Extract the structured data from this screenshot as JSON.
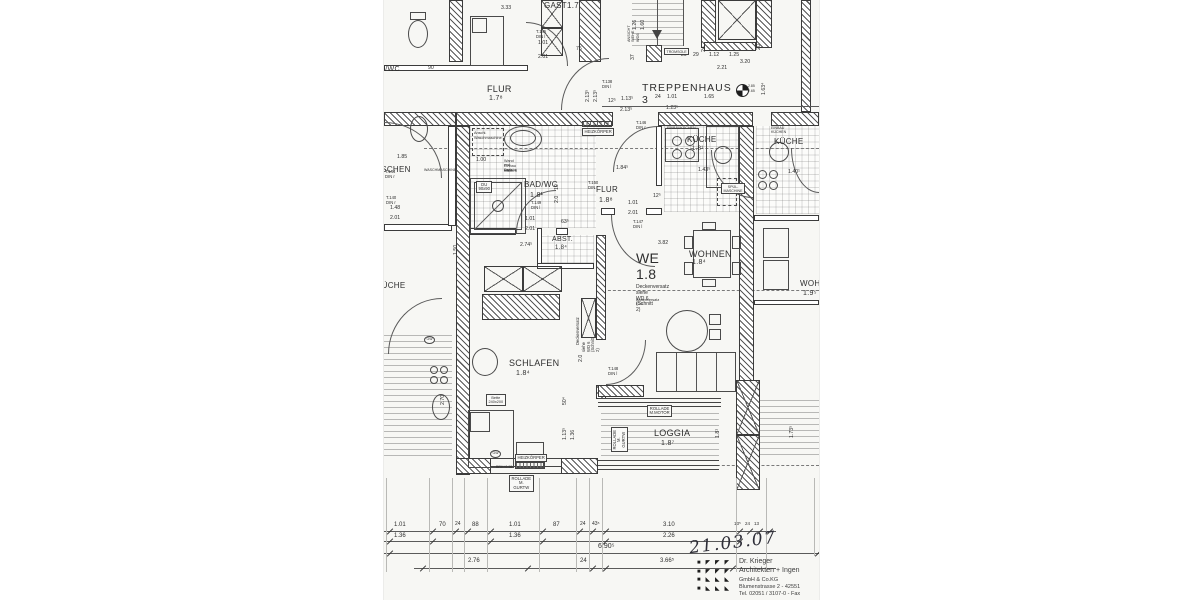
{
  "plan": {
    "room_labels": [
      {
        "t": "GAST1.7",
        "x": 160,
        "y": 2,
        "fs": 8
      },
      {
        "t": "FLUR",
        "x": 103,
        "y": 84,
        "fs": 9
      },
      {
        "t": "1.7⁸",
        "x": 105,
        "y": 95,
        "fs": 7
      },
      {
        "t": "TREPPENHAUS 3",
        "x": 258,
        "y": 83,
        "fs": 10.5,
        "sp": 1
      },
      {
        "t": "BAD/WC",
        "x": 140,
        "y": 181,
        "fs": 8
      },
      {
        "t": "1.8¹",
        "x": 146,
        "y": 192,
        "fs": 7
      },
      {
        "t": "FLUR",
        "x": 212,
        "y": 186,
        "fs": 8
      },
      {
        "t": "1.8⁸",
        "x": 215,
        "y": 197,
        "fs": 7
      },
      {
        "t": "KÜCHE",
        "x": 303,
        "y": 136,
        "fs": 8
      },
      {
        "t": "1.8¹",
        "x": 308,
        "y": 146,
        "fs": 6
      },
      {
        "t": "ABST.",
        "x": 168,
        "y": 236,
        "fs": 7
      },
      {
        "t": "1.8⁴",
        "x": 171,
        "y": 245,
        "fs": 6
      },
      {
        "t": "WE 1.8",
        "x": 252,
        "y": 251,
        "fs": 14
      },
      {
        "t": "WOHNEN",
        "x": 305,
        "y": 249,
        "fs": 9
      },
      {
        "t": "1.8⁴",
        "x": 308,
        "y": 259,
        "fs": 7
      },
      {
        "t": "SCHLAFEN",
        "x": 125,
        "y": 358,
        "fs": 9
      },
      {
        "t": "1.8⁴",
        "x": 132,
        "y": 370,
        "fs": 7
      },
      {
        "t": "LOGGIA",
        "x": 270,
        "y": 428,
        "fs": 9
      },
      {
        "t": "1.8⁷",
        "x": 277,
        "y": 440,
        "fs": 7
      },
      {
        "t": "BAD/WC",
        "x": -14,
        "y": 66,
        "fs": 7
      },
      {
        "t": "WASCHEN",
        "x": -16,
        "y": 166,
        "fs": 8
      },
      {
        "t": "KÜCHE",
        "x": -8,
        "y": 282,
        "fs": 8
      },
      {
        "t": "KÜCHE",
        "x": 390,
        "y": 138,
        "fs": 8
      },
      {
        "t": "WOHNEN",
        "x": 416,
        "y": 280,
        "fs": 8
      },
      {
        "t": "1.9⁵",
        "x": 419,
        "y": 290,
        "fs": 7
      }
    ],
    "door_tags": [
      {
        "t": "T.145\nDIN l",
        "x": 152,
        "y": 30
      },
      {
        "t": "T.138\nDIN l",
        "x": 218,
        "y": 80
      },
      {
        "t": "T.146\nDIN r",
        "x": 252,
        "y": 121
      },
      {
        "t": "T.144\nDIN r",
        "x": 1,
        "y": 170
      },
      {
        "t": "T.140\nDIN r",
        "x": 2,
        "y": 196
      },
      {
        "t": "T.150\nDIN r",
        "x": 204,
        "y": 181
      },
      {
        "t": "T.149\nDIN l",
        "x": 147,
        "y": 201
      },
      {
        "t": "T.147\nDIN l",
        "x": 249,
        "y": 220
      },
      {
        "t": "T.148\nDIN l",
        "x": 224,
        "y": 367
      }
    ],
    "dim_labels": [
      {
        "t": "3.33",
        "x": 117,
        "y": 6
      },
      {
        "t": "1.01",
        "x": 154,
        "y": 41
      },
      {
        "t": "2.01",
        "x": 154,
        "y": 55
      },
      {
        "t": "75",
        "x": 192,
        "y": 47
      },
      {
        "t": "90",
        "x": 44,
        "y": 66
      },
      {
        "t": "1.26",
        "x": 249,
        "y": 30,
        "rot": -90
      },
      {
        "t": "1.60",
        "x": 257,
        "y": 30,
        "rot": -90
      },
      {
        "t": "37",
        "x": 247,
        "y": 60,
        "rot": -90
      },
      {
        "t": "2.13⁵",
        "x": 202,
        "y": 102,
        "rot": -90
      },
      {
        "t": "2.13⁵",
        "x": 210,
        "y": 102,
        "rot": -90
      },
      {
        "t": "12⁵",
        "x": 224,
        "y": 99
      },
      {
        "t": "1.13⁵",
        "x": 237,
        "y": 97
      },
      {
        "t": "2.13⁵",
        "x": 236,
        "y": 108
      },
      {
        "t": "24",
        "x": 271,
        "y": 95
      },
      {
        "t": "1.01",
        "x": 283,
        "y": 95
      },
      {
        "t": "1.23⁵",
        "x": 282,
        "y": 106
      },
      {
        "t": "1.65",
        "x": 320,
        "y": 95
      },
      {
        "t": "24",
        "x": 318,
        "y": 52,
        "rot": -90
      },
      {
        "t": "20",
        "x": 373,
        "y": 50,
        "rot": -90
      },
      {
        "t": "29",
        "x": 297,
        "y": 53
      },
      {
        "t": "29",
        "x": 309,
        "y": 53
      },
      {
        "t": "1.12",
        "x": 325,
        "y": 53
      },
      {
        "t": "1.25",
        "x": 345,
        "y": 53
      },
      {
        "t": "3.20",
        "x": 356,
        "y": 60
      },
      {
        "t": "2.21",
        "x": 333,
        "y": 66
      },
      {
        "t": "1.63⁴",
        "x": 378,
        "y": 95,
        "rot": -90
      },
      {
        "t": "1.85",
        "x": 13,
        "y": 155
      },
      {
        "t": "1.00",
        "x": 92,
        "y": 158
      },
      {
        "t": "1.84⁵",
        "x": 232,
        "y": 166
      },
      {
        "t": "1.43⁵",
        "x": 314,
        "y": 168
      },
      {
        "t": "1.40¹",
        "x": 404,
        "y": 170
      },
      {
        "t": "10",
        "x": 171,
        "y": 190,
        "rot": -90
      },
      {
        "t": "2.0",
        "x": 171,
        "y": 203,
        "rot": -90
      },
      {
        "t": "1.48",
        "x": 6,
        "y": 206
      },
      {
        "t": "2.01",
        "x": 6,
        "y": 216
      },
      {
        "t": "1.01",
        "x": 141,
        "y": 217
      },
      {
        "t": "2.01",
        "x": 141,
        "y": 227
      },
      {
        "t": "63⁵",
        "x": 177,
        "y": 220
      },
      {
        "t": "1.01",
        "x": 244,
        "y": 201
      },
      {
        "t": "2.01",
        "x": 244,
        "y": 211
      },
      {
        "t": "12⁵",
        "x": 269,
        "y": 194
      },
      {
        "t": "2.74⁵",
        "x": 136,
        "y": 243
      },
      {
        "t": "3.82",
        "x": 274,
        "y": 241
      },
      {
        "t": "1.50",
        "x": 70,
        "y": 255,
        "rot": -90
      },
      {
        "t": "2.70",
        "x": 57,
        "y": 405,
        "rot": -90
      },
      {
        "t": "50⁴",
        "x": 179,
        "y": 405,
        "rot": -90
      },
      {
        "t": "1.13⁵",
        "x": 179,
        "y": 440,
        "rot": -90
      },
      {
        "t": "1.36",
        "x": 187,
        "y": 440,
        "rot": -90
      },
      {
        "t": "2.0",
        "x": 195,
        "y": 362,
        "rot": -90
      },
      {
        "t": "1.8¹",
        "x": 332,
        "y": 438,
        "rot": -90
      },
      {
        "t": "1.73⁵",
        "x": 406,
        "y": 438,
        "rot": -90
      },
      {
        "t": "1.01",
        "x": 10,
        "y": 522,
        "fs": 6
      },
      {
        "t": "70",
        "x": 55,
        "y": 522,
        "fs": 6
      },
      {
        "t": "24",
        "x": 71,
        "y": 522,
        "fs": 5
      },
      {
        "t": "88",
        "x": 88,
        "y": 522,
        "fs": 6
      },
      {
        "t": "1.01",
        "x": 125,
        "y": 522,
        "fs": 6
      },
      {
        "t": "87",
        "x": 169,
        "y": 522,
        "fs": 6
      },
      {
        "t": "24",
        "x": 196,
        "y": 522,
        "fs": 5
      },
      {
        "t": "43⁵",
        "x": 208,
        "y": 522,
        "fs": 5
      },
      {
        "t": "3.10",
        "x": 279,
        "y": 522,
        "fs": 6
      },
      {
        "t": "13⁵",
        "x": 350,
        "y": 521,
        "fs": 4.5
      },
      {
        "t": "24",
        "x": 361,
        "y": 521,
        "fs": 4.5
      },
      {
        "t": "13",
        "x": 370,
        "y": 521,
        "fs": 4.5
      },
      {
        "t": "1.36",
        "x": 10,
        "y": 533,
        "fs": 6
      },
      {
        "t": "1.36",
        "x": 125,
        "y": 533,
        "fs": 6
      },
      {
        "t": "2.26",
        "x": 279,
        "y": 533,
        "fs": 6
      },
      {
        "t": "6.90⁵",
        "x": 214,
        "y": 543,
        "fs": 7
      },
      {
        "t": "2.76",
        "x": 84,
        "y": 558,
        "fs": 6
      },
      {
        "t": "24",
        "x": 196,
        "y": 558,
        "fs": 6
      },
      {
        "t": "3.66⁵",
        "x": 276,
        "y": 558,
        "fs": 6
      }
    ],
    "notes": [
      {
        "t": "Deckenversatz",
        "x": 252,
        "y": 285,
        "fs": 5
      },
      {
        "t": "siehe WD 6 (Schnitt 2)",
        "x": 252,
        "y": 291,
        "fs": 5
      },
      {
        "t": "Bodenversatz E20",
        "x": 252,
        "y": 298,
        "fs": 3.8
      },
      {
        "t": "Deckenversatz",
        "x": 192,
        "y": 345,
        "fs": 4.2,
        "rot": -90
      },
      {
        "t": "siehe WD 6 (Schnitt 2)",
        "x": 198,
        "y": 352,
        "fs": 4.2,
        "rot": -90
      },
      {
        "t": "ANSICHT SIEHE WD6",
        "x": 243,
        "y": 42,
        "fs": 3.8,
        "rot": -90
      },
      {
        "t": "BRH+0.90",
        "x": 112,
        "y": 466,
        "fs": 3.5
      },
      {
        "t": "Wand erst nach",
        "x": 120,
        "y": 159,
        "fs": 3.8
      },
      {
        "t": "Einbau Dusche",
        "x": 120,
        "y": 164,
        "fs": 3.8
      },
      {
        "t": "mauern",
        "x": 120,
        "y": 169,
        "fs": 3.8
      },
      {
        "t": "Anschl.",
        "x": 90,
        "y": 131,
        "fs": 3.8
      },
      {
        "t": "Waschmaschine",
        "x": 90,
        "y": 136,
        "fs": 3.8
      },
      {
        "t": "EINBAUKÜCHEN",
        "x": 283,
        "y": 126,
        "fs": 3.6
      },
      {
        "t": "EINBAU KÜCHEN",
        "x": 387,
        "y": 126,
        "fs": 3.6
      },
      {
        "t": "2.85",
        "x": 364,
        "y": 85,
        "fs": 3.5
      },
      {
        "t": "2.65",
        "x": 364,
        "y": 90,
        "fs": 3.5
      },
      {
        "t": "WASCHMASCHINE",
        "x": 40,
        "y": 168,
        "fs": 3.6
      }
    ],
    "boxed_labels": [
      {
        "t": "HEIZKÖRPER",
        "x": 198,
        "y": 128
      },
      {
        "t": "HEIZKÖRPER",
        "x": 131,
        "y": 454
      },
      {
        "t": "TROMSOLE",
        "x": 280,
        "y": 48,
        "fs": 3.6
      },
      {
        "t": "DU 90x90",
        "x": 92,
        "y": 181
      },
      {
        "t": "SPÜL-\nMASCHINE",
        "x": 337,
        "y": 183,
        "fs": 3.6
      },
      {
        "t": "ROLLADE\nM.MOTOR",
        "x": 263,
        "y": 405
      },
      {
        "t": "ROLLADE\nM. GURTW",
        "x": 125,
        "y": 475
      },
      {
        "t": "ROLLADE\nM. GURTW",
        "x": 227,
        "y": 452,
        "rot": -90
      },
      {
        "t": "Bette 240x200",
        "x": 102,
        "y": 394,
        "fs": 3.8
      }
    ],
    "circle_tags": [
      {
        "t": "GW",
        "x": 106,
        "y": 450
      },
      {
        "t": "GW",
        "x": 40,
        "y": 336
      }
    ],
    "chain_lines": [
      {
        "x1": 0,
        "y": 531,
        "x2": 392
      },
      {
        "x1": 0,
        "y": 541,
        "x2": 357
      },
      {
        "x1": 0,
        "y": 553,
        "x2": 435
      },
      {
        "x1": 30,
        "y": 568,
        "x2": 392
      },
      {
        "x1": 218,
        "y": 106,
        "x2": 435
      }
    ],
    "ext_lines": [
      {
        "x": 2,
        "y1": 478,
        "y2": 572
      },
      {
        "x": 45,
        "y1": 478,
        "y2": 572
      },
      {
        "x": 68,
        "y1": 478,
        "y2": 572
      },
      {
        "x": 80,
        "y1": 478,
        "y2": 572
      },
      {
        "x": 103,
        "y1": 478,
        "y2": 572
      },
      {
        "x": 155,
        "y1": 478,
        "y2": 572
      },
      {
        "x": 192,
        "y1": 478,
        "y2": 572
      },
      {
        "x": 205,
        "y1": 478,
        "y2": 572
      },
      {
        "x": 218,
        "y1": 478,
        "y2": 572
      },
      {
        "x": 352,
        "y1": 478,
        "y2": 572
      },
      {
        "x": 382,
        "y1": 478,
        "y2": 572
      },
      {
        "x": 430,
        "y1": 478,
        "y2": 556
      }
    ],
    "ticks": [
      {
        "x": 2,
        "y": 531
      },
      {
        "x": 45,
        "y": 531
      },
      {
        "x": 68,
        "y": 531
      },
      {
        "x": 80,
        "y": 531
      },
      {
        "x": 103,
        "y": 531
      },
      {
        "x": 155,
        "y": 531
      },
      {
        "x": 192,
        "y": 531
      },
      {
        "x": 205,
        "y": 531
      },
      {
        "x": 218,
        "y": 531
      },
      {
        "x": 352,
        "y": 531
      },
      {
        "x": 362,
        "y": 531
      },
      {
        "x": 372,
        "y": 531
      },
      {
        "x": 382,
        "y": 531
      },
      {
        "x": 2,
        "y": 541
      },
      {
        "x": 45,
        "y": 541
      },
      {
        "x": 103,
        "y": 541
      },
      {
        "x": 155,
        "y": 541
      },
      {
        "x": 218,
        "y": 541
      },
      {
        "x": 352,
        "y": 541
      },
      {
        "x": 2,
        "y": 553
      },
      {
        "x": 430,
        "y": 553
      },
      {
        "x": 35,
        "y": 568
      },
      {
        "x": 140,
        "y": 568
      },
      {
        "x": 205,
        "y": 568
      },
      {
        "x": 218,
        "y": 568
      },
      {
        "x": 345,
        "y": 568
      }
    ]
  },
  "stamp": {
    "date": "21.03.07",
    "firm_name": "Dr. Krieger",
    "firm_type": "Architekten + Ingen",
    "firm_legal": "GmbH & Co.KG",
    "firm_address": "Blumenstrasse 2 - 42551",
    "firm_phone": "Tel. 02051 / 3107-0 - Fax",
    "logo_rows": [
      "■ ◤ ◤ ◤",
      "■ ◤ ◤ ◤",
      "■ ◣ ◣ ◣",
      "■ ◣ ◣ ◣"
    ]
  }
}
